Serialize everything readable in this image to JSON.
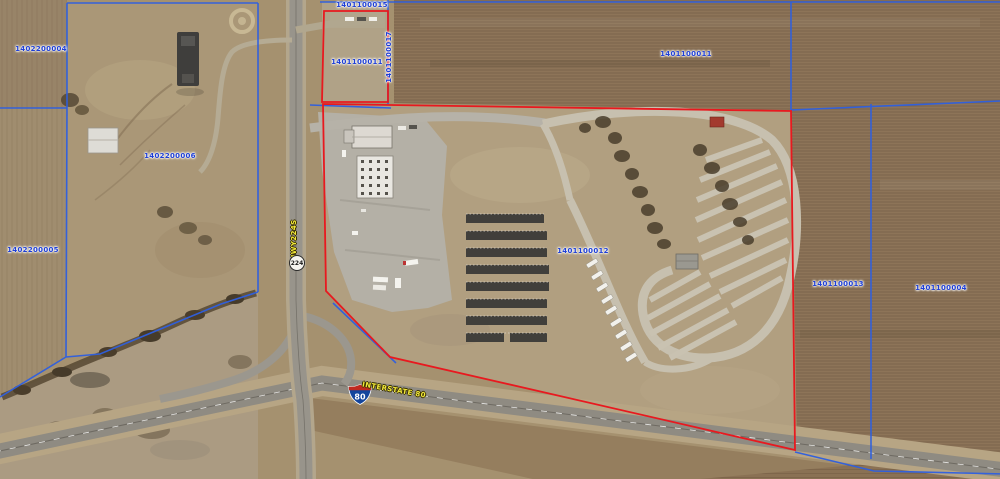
{
  "map": {
    "parcel_labels": [
      {
        "id": "1402200004",
        "x": 41,
        "y": 49,
        "rot": 0
      },
      {
        "id": "1401100015",
        "x": 362,
        "y": 5,
        "rot": 0
      },
      {
        "id": "1401100011",
        "x": 357,
        "y": 62,
        "rot": 0
      },
      {
        "id": "1401100017",
        "x": 389,
        "y": 57,
        "rot": -90
      },
      {
        "id": "1401100011",
        "x": 686,
        "y": 54,
        "rot": 0
      },
      {
        "id": "1402200006",
        "x": 170,
        "y": 156,
        "rot": 0
      },
      {
        "id": "1402200005",
        "x": 33,
        "y": 250,
        "rot": 0
      },
      {
        "id": "1401100012",
        "x": 583,
        "y": 251,
        "rot": 0
      },
      {
        "id": "1401100013",
        "x": 838,
        "y": 284,
        "rot": 0
      },
      {
        "id": "1401100004",
        "x": 941,
        "y": 288,
        "rot": 0
      }
    ],
    "road_labels": {
      "route_marker": "224",
      "route_name": "HWY224S",
      "interstate_marker": "80",
      "interstate_name": "INTERSTATE 80"
    },
    "colors": {
      "parcel_boundary": "#2e5fe0",
      "selected_boundary": "#e8191f",
      "parcel_label_text": "#1d3ed6",
      "road_label_text": "#f2e93b"
    }
  }
}
